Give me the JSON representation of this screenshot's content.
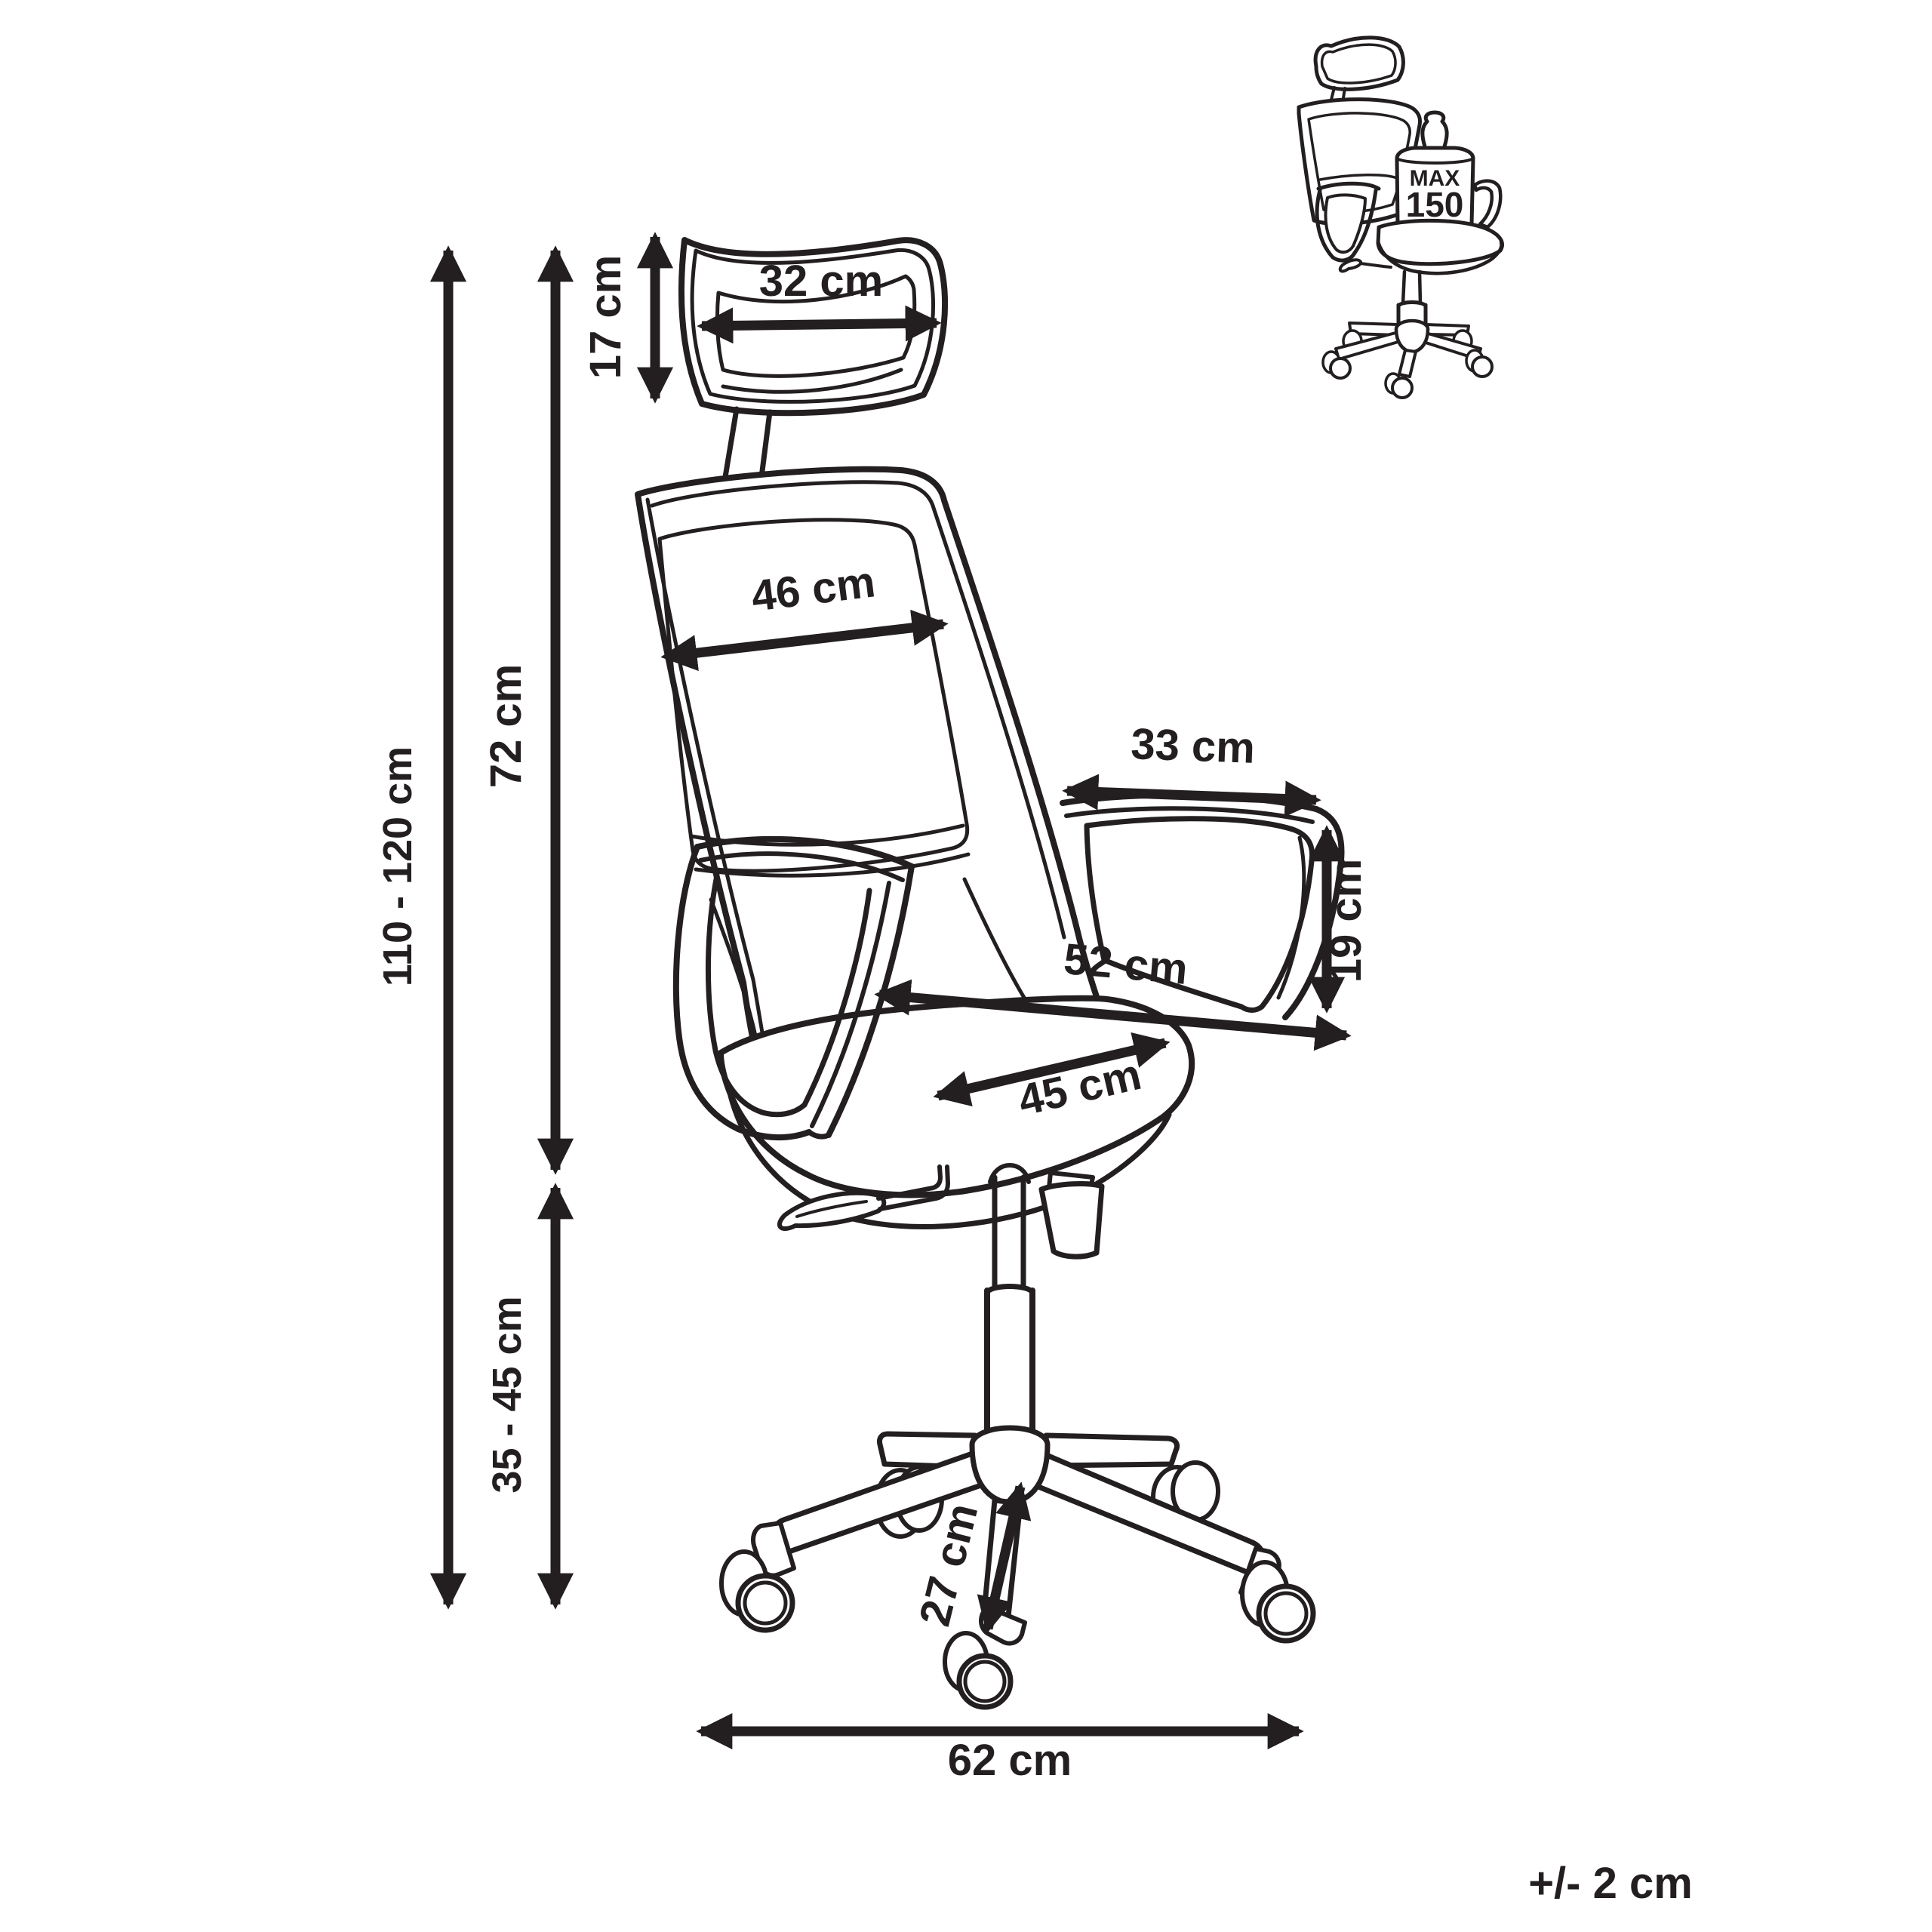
{
  "canvas": {
    "background": "#ffffff",
    "ink": "#231f20"
  },
  "dims": {
    "overall": "110 - 120 cm",
    "back_h": "72 cm",
    "seat_h": "35 - 45 cm",
    "head_h": "17 cm",
    "head_w": "32 cm",
    "back_w": "46 cm",
    "arm_l": "33 cm",
    "arm_h": "19 cm",
    "seat_w": "52 cm",
    "seat_d": "45 cm",
    "leg": "27 cm",
    "base_w": "62 cm"
  },
  "weight": {
    "l1": "MAX",
    "l2": "150",
    "l3": "kg"
  },
  "tolerance": "+/- 2 cm"
}
